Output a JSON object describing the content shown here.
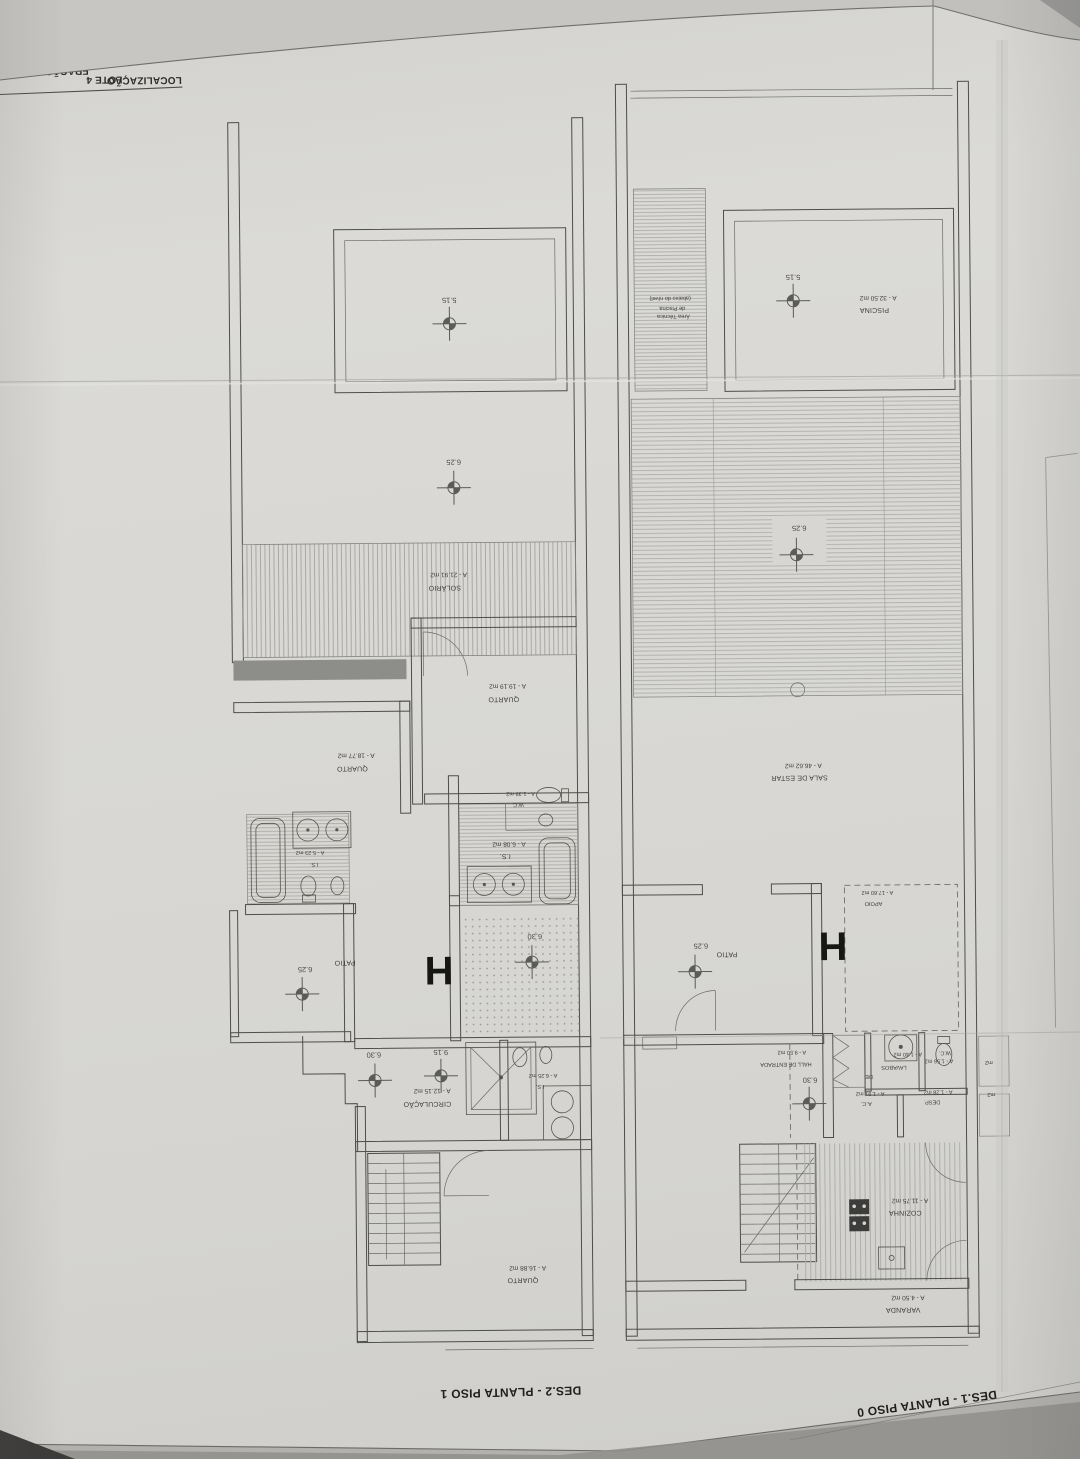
{
  "photo": {
    "paper_color": "#d8d7d3",
    "line_color": "#4c4c4a",
    "text_color": "#3c3c3a",
    "shadow_color": "#8f8e8b"
  },
  "title_block": {
    "descricao_label": "DESCRIÇÃO",
    "descricao_value": "PLANTAS_ARQUITETU",
    "localizacao_label": "LOCALIZAÇÃO",
    "localizacao_value": "LOTE 4",
    "fracao_value": "FRAÇÃO \"H\"_MORAD"
  },
  "piso1": {
    "caption": "DES.2 - PLANTA PISO 1",
    "unit_letter": "H",
    "rooms": {
      "solario": {
        "name": "SOLÁRIO",
        "area": "A - 21.91 m2"
      },
      "quarto_top": {
        "name": "QUARTO",
        "area": "A - 19.19 m2"
      },
      "quarto_mid": {
        "name": "QUARTO",
        "area": "A - 18.77 m2"
      },
      "quarto_bottom": {
        "name": "QUARTO",
        "area": "A - 16.88 m2"
      },
      "is_left": {
        "name": "I.S.",
        "area": "A - 5.23 m2"
      },
      "is_right": {
        "name": "I.S.",
        "area": "A - 6.08 m2"
      },
      "is_lower": {
        "name": "I.S.",
        "area": "A - 6.25 m2"
      },
      "wc": {
        "name": "W.C.",
        "area": "A - 1.39 m2"
      },
      "patio": {
        "name": "PATIO"
      },
      "circulacao": {
        "name": "CIRCULAÇÃO",
        "area": "A - 12.15 m2"
      }
    },
    "levels": {
      "pool": "5.15",
      "terrace": "6.25",
      "patio": "6.25",
      "hall": "6.30",
      "circ": "6.30",
      "stair": "9.15"
    }
  },
  "piso0": {
    "caption": "DES.1 - PLANTA PISO 0",
    "unit_letter": "H",
    "rooms": {
      "piscina": {
        "name": "PISCINA",
        "area": "A - 32.50 m2"
      },
      "area_tecnica_l1": "Área Técnica",
      "area_tecnica_l2": "de Piscina",
      "area_tecnica_l3": "(abaixo do nível)",
      "sala": {
        "name": "SALA DE ESTAR",
        "area": "A - 46.62 m2"
      },
      "apoio": {
        "name": "APOIO",
        "area": "A - 17.60 m2"
      },
      "patio": {
        "name": "PATIO"
      },
      "hall": {
        "name": "HALL DE ENTRADA",
        "area": "A - 9.50 m2"
      },
      "ac": {
        "name": "A.C.",
        "area": "A - 1.91 m2"
      },
      "lavabos": {
        "name": "LAVABOS",
        "area": "A - 1.40 m2"
      },
      "wc": {
        "name": "W.C.",
        "area": "A - 1.56 m2"
      },
      "desp": {
        "name": "DESP.",
        "area": "A - 1.28 m2"
      },
      "de": "DE",
      "cozinha": {
        "name": "COZINHA",
        "area": "A - 11.75 m2"
      },
      "varanda": {
        "name": "VARANDA",
        "area": "A - 4.50 m2"
      }
    },
    "levels": {
      "pool": "5.15",
      "pergola": "6.25",
      "patio": "6.25",
      "hall": "6.30"
    },
    "edge_fragments": {
      "f1": "m2",
      "f2": "m2"
    }
  }
}
